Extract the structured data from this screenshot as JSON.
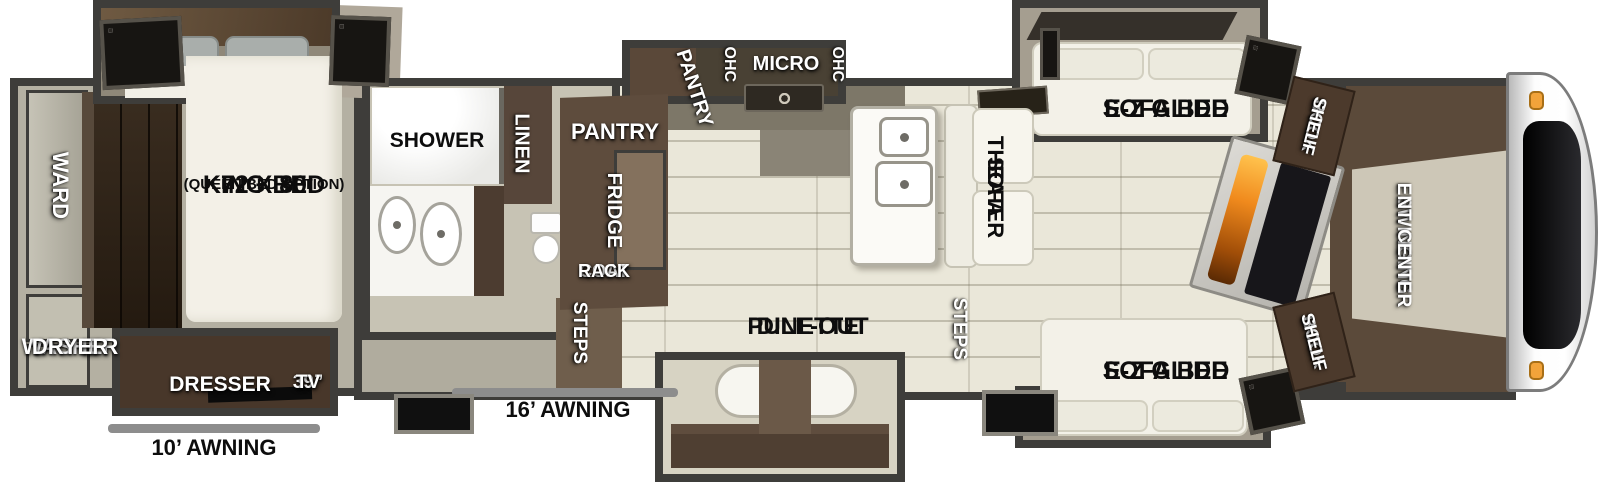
{
  "title": "Fifth-wheel RV floorplan",
  "colors": {
    "wall": "#3e3d3a",
    "floor_living": "#eae7d9",
    "floor_bedroom": "#b4b0a2",
    "floor_bath": "#c7c3b4",
    "cabinet_brown": "#5e4c3d",
    "cabinet_dark_brown": "#48372a",
    "furniture_white": "#f3f1e8",
    "awning_gray": "#8d8d8d",
    "flame_orange": "#f08a1d",
    "marker_light_orange": "#f2a33a",
    "label_black": "#0d0d0d",
    "label_white": "#ffffff"
  },
  "bedroom": {
    "ward": "WARD",
    "king_bed_size": "72 X 80",
    "king_bed": "KING BED",
    "king_bed_option": "(QUEEN BED OPTION)",
    "washer": "WASHER",
    "dryer": "DRYER",
    "dresser": "DRESSER",
    "tv_size": "39”",
    "tv": "TV",
    "awning": "10’ AWNING"
  },
  "bathroom": {
    "shower": "SHOWER",
    "linen": "LINEN"
  },
  "kitchen": {
    "pantry": "PANTRY",
    "fridge": "FRIDGE",
    "coat_rack_line1": "COAT",
    "coat_rack_line2": "RACK",
    "steps": "STEPS",
    "pantry_slide": "PANTRY",
    "ohc_left": "OHC",
    "micro": "MICRO",
    "ohc_right": "OHC",
    "dinette_line1": "PULL-OUT",
    "dinette_line2": "DINETTE",
    "awning": "16’ AWNING"
  },
  "living": {
    "theater_line1": "THEATER",
    "theater_line2": "SOFA",
    "steps": "STEPS",
    "sofa_top_line1": "E-Z GLIDE",
    "sofa_top_line2": "SOFA BED",
    "sofa_bottom_line1": "E-Z GLIDE",
    "sofa_bottom_line2": "SOFA BED",
    "bookshelf_top_line1": "BOOK",
    "bookshelf_top_line2": "SHELF",
    "ent_center_line1": "SWINGING",
    "ent_center_line2": "ENT. CENTER",
    "bookshelf_bottom_line1": "BOOK",
    "bookshelf_bottom_line2": "SHELF"
  }
}
